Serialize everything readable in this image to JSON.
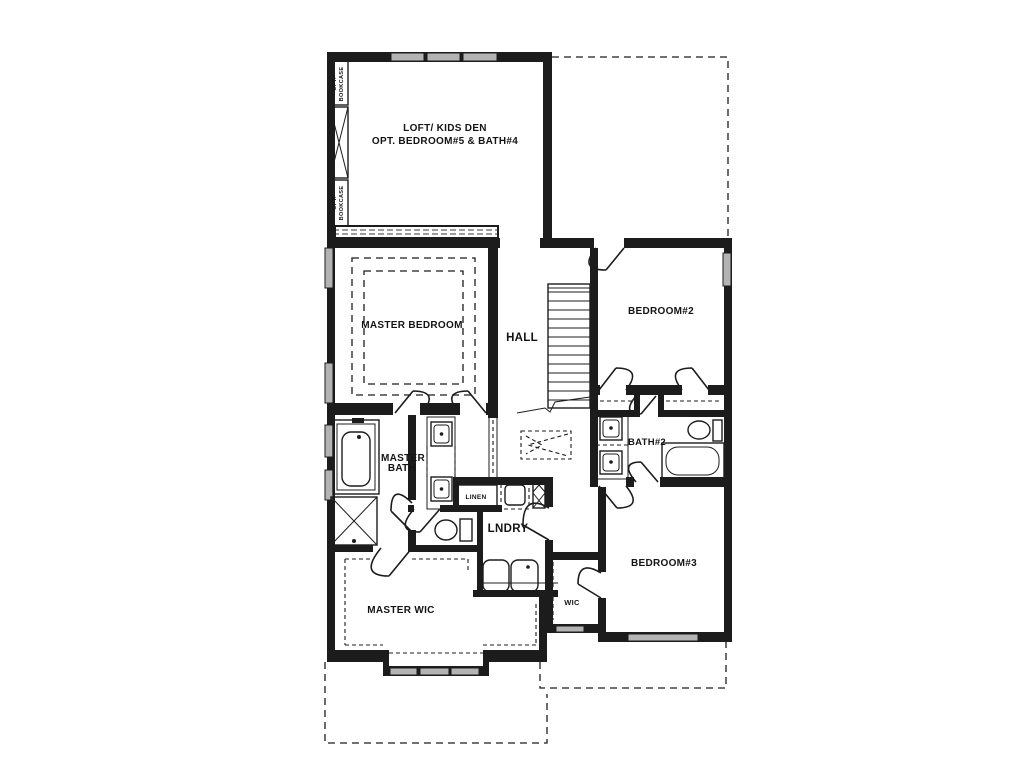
{
  "labels": {
    "loft": {
      "line1": "LOFT/ KIDS DEN",
      "line2": "OPT. BEDROOM#5 & BATH#4"
    },
    "bookcase_top": {
      "line1": "OPT.",
      "line2": "BOOKCASE"
    },
    "bookcase_bottom": {
      "line1": "OPT.",
      "line2": "BOOKCASE"
    },
    "master_bedroom": "MASTER BEDROOM",
    "hall": "HALL",
    "bedroom2": "BEDROOM#2",
    "master_bath": {
      "line1": "MASTER",
      "line2": "BATH"
    },
    "bath2": "BATH#2",
    "linen": "LINEN",
    "laundry": "LNDRY",
    "bedroom3": "BEDROOM#3",
    "master_wic": "MASTER WIC",
    "wic": "WIC"
  },
  "colors": {
    "line": "#1c1c1c",
    "window_fill": "#b3b3b3",
    "background": "#ffffff"
  }
}
